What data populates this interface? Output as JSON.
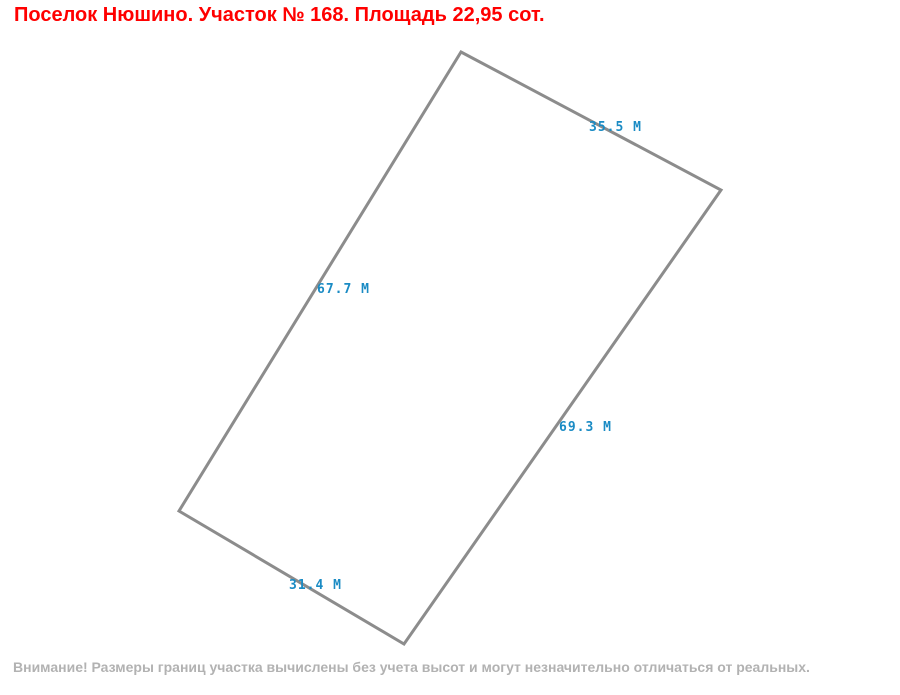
{
  "title": "Поселок Нюшино. Участок № 168. Площадь 22,95 сот.",
  "parcel": {
    "polygon_points": "461,52 721,190 404,644 179,511",
    "sides": [
      {
        "name": "north-east-side",
        "label": "35.5 М"
      },
      {
        "name": "north-west-side",
        "label": "67.7 М"
      },
      {
        "name": "south-east-side",
        "label": "69.3 М"
      },
      {
        "name": "south-west-side",
        "label": "31.4 М"
      }
    ]
  },
  "footer": "Внимание! Размеры границ участка вычислены без учета высот и могут незначительно отличаться от реальных.",
  "colors": {
    "title": "#ff0000",
    "boundary": "#8c8c8c",
    "measurement": "#1a8bc4",
    "disclaimer": "#b2b2b2"
  }
}
